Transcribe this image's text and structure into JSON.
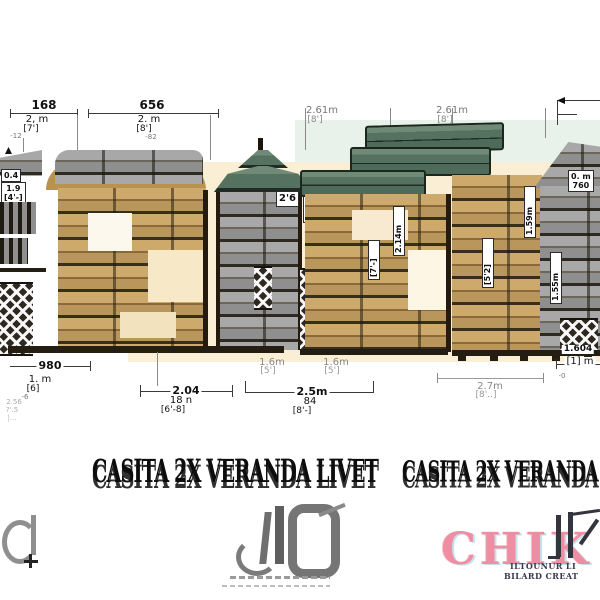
{
  "title": {
    "text": "CASITA 2X VERANDA LIVET"
  },
  "dims_top": {
    "d1": {
      "num": "168",
      "m": "2, m",
      "ft": "[7']",
      "tiny": "-12"
    },
    "d2": {
      "num": "656",
      "m": "2. m",
      "ft": "[8']",
      "tiny": "-82"
    },
    "d3": {
      "m": "2.61m",
      "ft": "[8']"
    },
    "d4": {
      "m": "2.61m",
      "ft": "[8']"
    }
  },
  "dims_bottom": {
    "d980": {
      "num": "980",
      "m": "1. m",
      "ft": "[6]",
      "tiny": "-6",
      "faint1": "2.56",
      "faint2": "?'.5",
      "faint3": "|..."
    },
    "d204": {
      "num": "2.04",
      "inch": "18 n",
      "ft": "[6'-8]"
    },
    "d16a": {
      "m": "1.6m",
      "ft": "[5']"
    },
    "d16b": {
      "m": "1.6m",
      "ft": "[5']"
    },
    "d25": {
      "num": "2.5m",
      "inch": "84",
      "ft": "[8'-]"
    },
    "d27": {
      "m": "2.7m",
      "ft": "[8'..]"
    },
    "d1604": {
      "num": "1.604",
      "m": "[1] m",
      "tiny": "-0"
    }
  },
  "labels": {
    "mini_a": "0.4",
    "mini_b": "1.9",
    "mini_c": "[4'-]",
    "pagoda_a": "2'6",
    "pagoda_b": "0.51m",
    "pagoda_c": "42",
    "pagoda_d": "[-2]",
    "rot_left": "2.46m",
    "rot_mid": "2.14m",
    "rot_mid2": "[7'-]",
    "right_a": "0. m",
    "right_b": "760",
    "rot_r1": "1.59m",
    "rot_r2": "[5'2]",
    "rot_r3": "1.55m"
  },
  "logos": {
    "right_text": "CHIK",
    "right_line1": "ILTOUNUR LI",
    "right_line2": "BILARD CREAT"
  },
  "colors": {
    "wall_tan": "#c9a76c",
    "wall_gray": "#8f8f8f",
    "roof_green": "#55715f",
    "wash_cream": "#faefd4",
    "wash_green": "#e8f2ea",
    "logo_pink": "#ef8da3"
  }
}
